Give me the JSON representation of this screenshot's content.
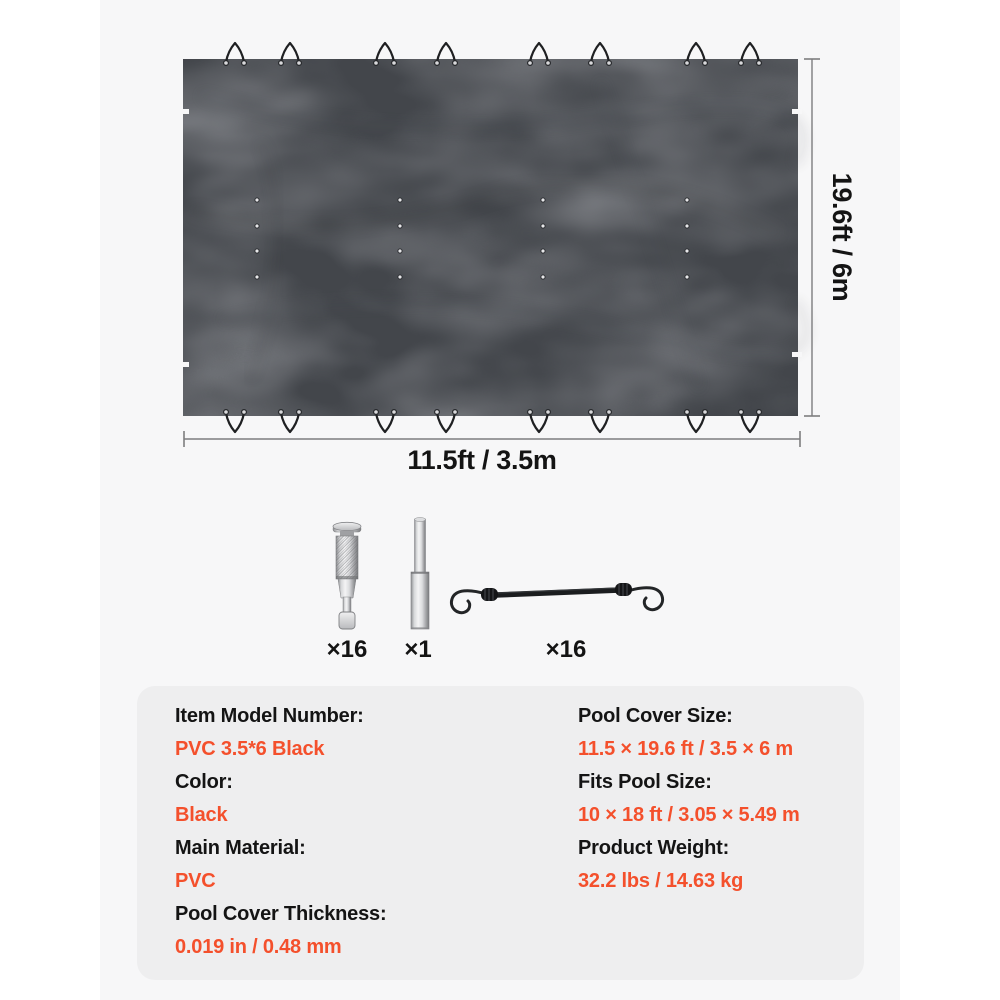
{
  "diagram": {
    "width_label": "11.5ft / 3.5m",
    "height_label": "19.6ft / 6m",
    "tie_loops_top": 8,
    "tie_loops_bottom": 8,
    "drain_grommet_grid": "4 x 4",
    "side_tabs_per_side": 2
  },
  "hardware": {
    "items": [
      {
        "name": "deck-anchor",
        "count": "×16"
      },
      {
        "name": "installation-rod",
        "count": "×1"
      },
      {
        "name": "bungee-cord",
        "count": "×16"
      }
    ]
  },
  "specs": {
    "left": [
      {
        "label": "Item Model Number:",
        "value": "PVC 3.5*6 Black"
      },
      {
        "label": "Color:",
        "value": "Black"
      },
      {
        "label": "Main Material:",
        "value": "PVC"
      },
      {
        "label": "Pool Cover Thickness:",
        "value": "0.019 in / 0.48 mm"
      }
    ],
    "right": [
      {
        "label": "Pool Cover Size:",
        "value": "11.5 × 19.6 ft / 3.5 × 6 m"
      },
      {
        "label": "Fits Pool Size:",
        "value": "10 × 18 ft / 3.05 × 5.49 m"
      },
      {
        "label": "Product Weight:",
        "value": "32.2 lbs / 14.63 kg"
      }
    ]
  },
  "colors": {
    "accent_orange": "#f4502c",
    "cover": "#43464b",
    "panel_bg": "#eeeeef",
    "inner_bg": "#f7f7f8"
  }
}
